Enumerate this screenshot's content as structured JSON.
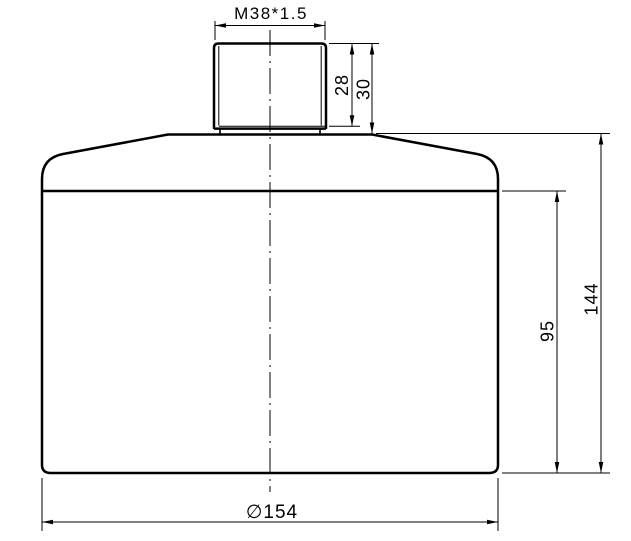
{
  "drawing": {
    "type": "technical-drawing",
    "part_description": "cylindrical container body with external threaded neck, front view with dimensions",
    "colors": {
      "line": "#000000",
      "background": "#ffffff"
    },
    "labels": {
      "thread_spec": "M38*1.5",
      "thread_length": "28",
      "neck_height": "30",
      "body_lower_height": "95",
      "body_total_height": "144",
      "body_diameter": "∅154"
    }
  }
}
